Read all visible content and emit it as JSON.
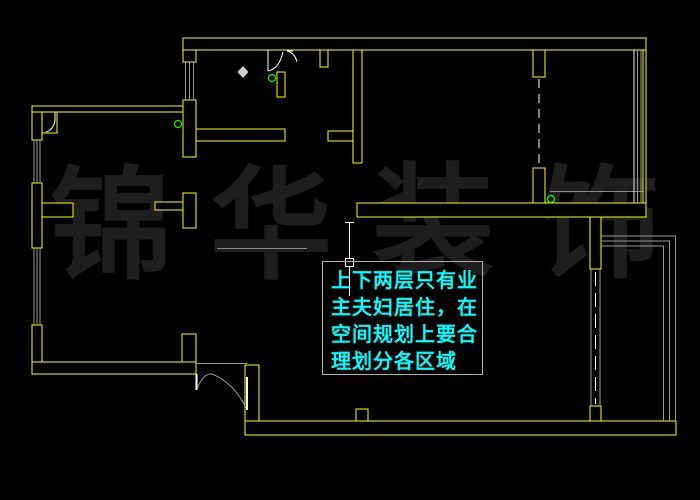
{
  "colors": {
    "background": "#000000",
    "wall": "#ffff00",
    "window_line": "#9b9b9b",
    "door_line": "#ffffff",
    "marker_green": "#00ff00",
    "diamond": "#cfcfcf",
    "annotation_text": "#00ffff",
    "annotation_border": "#b0b0b0",
    "watermark": "#1e1e1e"
  },
  "watermark": {
    "text": "锦华装饰",
    "chars": [
      "锦",
      "华",
      "装",
      "饰"
    ]
  },
  "annotation": {
    "lines": [
      "上下两层只有业",
      "主夫妇居住，在",
      "空间规划上要合",
      "理划分各区域"
    ]
  }
}
